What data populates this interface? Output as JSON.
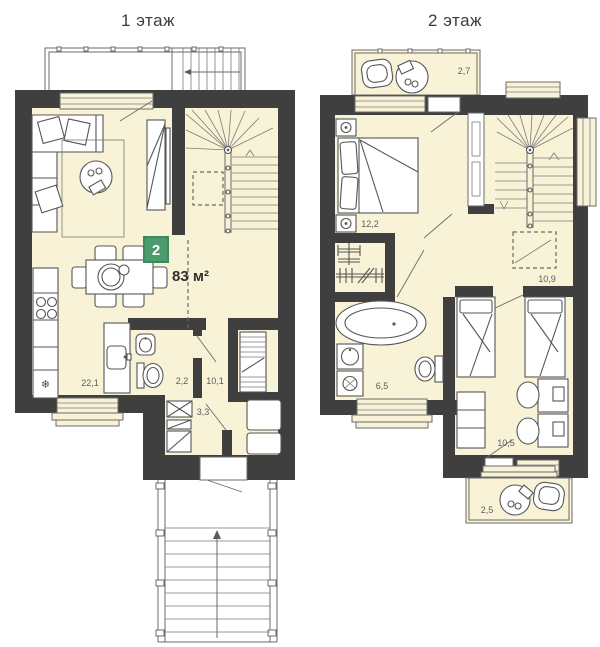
{
  "colors": {
    "wall": "#3f3f3f",
    "floor_fill": "#f8f3d7",
    "badge": "#4c9b6f",
    "badge_border": "#3a8a5e",
    "line": "#5f5f5f"
  },
  "floor1": {
    "title": "1 этаж",
    "badge_number": "2",
    "total_area": "83 м²",
    "rooms": {
      "kitchen_living": "22,1",
      "bathroom": "2,2",
      "hallway": "10,1",
      "storage": "3,3"
    },
    "fridge_symbol": "❄"
  },
  "floor2": {
    "title": "2 этаж",
    "rooms": {
      "balcony_top": "2,7",
      "bedroom": "12,2",
      "hall": "10,9",
      "bathroom": "6,5",
      "kids_room": "10,5",
      "balcony_bottom": "2,5"
    }
  }
}
